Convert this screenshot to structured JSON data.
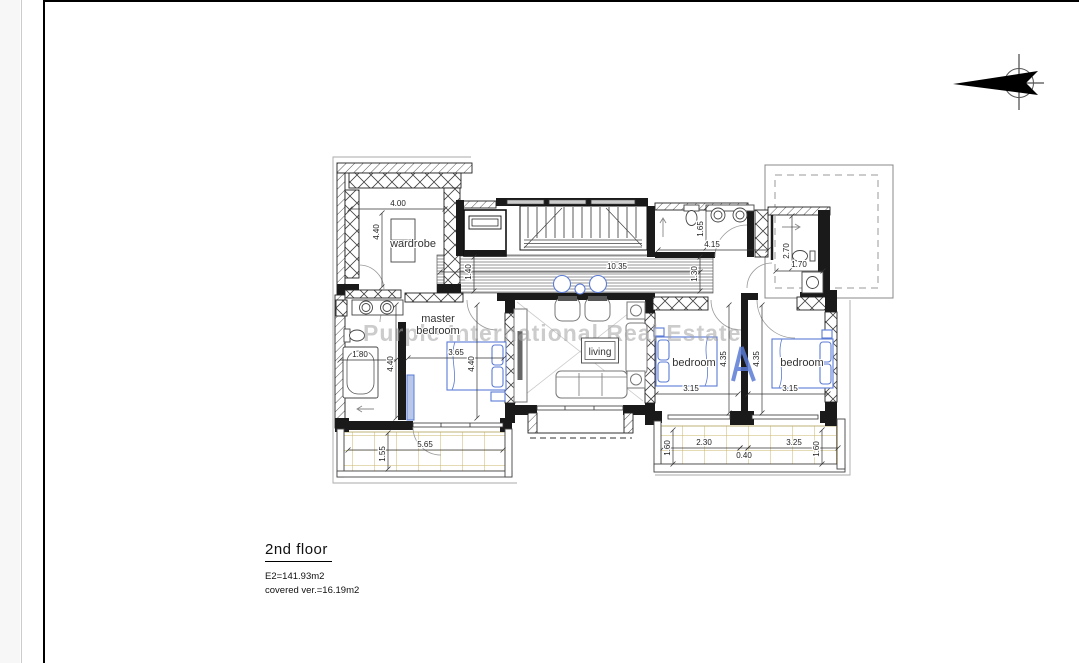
{
  "watermark": {
    "text": "Purple International Real Estate",
    "logo": "blue-a-logo"
  },
  "north_arrow": {
    "icon": "north-arrow-icon",
    "direction": "east"
  },
  "title_block": {
    "floor_label": "2nd floor",
    "area_line": "E2=141.93m2",
    "covered_line": "covered ver.=16.19m2"
  },
  "colors": {
    "wall": "#1a1a1a",
    "furniture_blue": "#5b7bd5",
    "tile": "#c8b668",
    "watermark": "#a3a3a3"
  },
  "plan": {
    "room_labels": [
      {
        "t": "wardrobe",
        "x": 413,
        "y": 247,
        "fs": 11
      },
      {
        "t": "master",
        "x": 438,
        "y": 322,
        "fs": 11
      },
      {
        "t": "bedroom",
        "x": 438,
        "y": 334,
        "fs": 11
      },
      {
        "t": "living",
        "x": 600,
        "y": 355,
        "fs": 10
      },
      {
        "t": "bedroom",
        "x": 694,
        "y": 366,
        "fs": 11
      },
      {
        "t": "bedroom",
        "x": 802,
        "y": 366,
        "fs": 11
      }
    ],
    "dimensions": [
      {
        "t": "4.00",
        "x": 398,
        "y": 206,
        "r": 0
      },
      {
        "t": "4.40",
        "x": 379,
        "y": 232,
        "r": -90
      },
      {
        "t": "10.35",
        "x": 617,
        "y": 269,
        "r": 0
      },
      {
        "t": "1.40",
        "x": 471,
        "y": 272,
        "r": -90
      },
      {
        "t": "4.15",
        "x": 712,
        "y": 247,
        "r": 0
      },
      {
        "t": "1.65",
        "x": 703,
        "y": 229,
        "r": -90
      },
      {
        "t": "1.30",
        "x": 697,
        "y": 274,
        "r": -90
      },
      {
        "t": "2.70",
        "x": 789,
        "y": 251,
        "r": -90
      },
      {
        "t": "1.70",
        "x": 799,
        "y": 267,
        "r": 0
      },
      {
        "t": "1.80",
        "x": 360,
        "y": 357,
        "r": 0
      },
      {
        "t": "4.40",
        "x": 393,
        "y": 364,
        "r": -90
      },
      {
        "t": "3.65",
        "x": 456,
        "y": 355,
        "r": 0
      },
      {
        "t": "4.40",
        "x": 474,
        "y": 364,
        "r": -90
      },
      {
        "t": "3.15",
        "x": 691,
        "y": 391,
        "r": 0
      },
      {
        "t": "4.35",
        "x": 726,
        "y": 359,
        "r": -90
      },
      {
        "t": "4.35",
        "x": 759,
        "y": 359,
        "r": -90
      },
      {
        "t": "3.15",
        "x": 790,
        "y": 391,
        "r": 0
      },
      {
        "t": "5.65",
        "x": 425,
        "y": 447,
        "r": 0
      },
      {
        "t": "1.55",
        "x": 385,
        "y": 454,
        "r": -90
      },
      {
        "t": "2.30",
        "x": 704,
        "y": 445,
        "r": 0
      },
      {
        "t": "0.40",
        "x": 744,
        "y": 458,
        "r": 0
      },
      {
        "t": "3.25",
        "x": 794,
        "y": 445,
        "r": 0
      },
      {
        "t": "1.60",
        "x": 670,
        "y": 448,
        "r": -90
      },
      {
        "t": "1.60",
        "x": 819,
        "y": 449,
        "r": -90
      }
    ],
    "dim_lines": [
      [
        350,
        209,
        445,
        209
      ],
      [
        382,
        213,
        382,
        287
      ],
      [
        440,
        272,
        700,
        272
      ],
      [
        474,
        257,
        474,
        291
      ],
      [
        658,
        250,
        768,
        250
      ],
      [
        706,
        208,
        706,
        248
      ],
      [
        700,
        257,
        700,
        291
      ],
      [
        792,
        216,
        792,
        268
      ],
      [
        776,
        271,
        823,
        271
      ],
      [
        340,
        360,
        396,
        360
      ],
      [
        396,
        305,
        396,
        418
      ],
      [
        408,
        358,
        504,
        358
      ],
      [
        477,
        305,
        477,
        418
      ],
      [
        656,
        394,
        738,
        394
      ],
      [
        729,
        305,
        729,
        413
      ],
      [
        762,
        305,
        762,
        413
      ],
      [
        748,
        394,
        828,
        394
      ],
      [
        348,
        450,
        503,
        450
      ],
      [
        388,
        433,
        388,
        469
      ],
      [
        663,
        448,
        740,
        448
      ],
      [
        740,
        448,
        748,
        448
      ],
      [
        748,
        448,
        838,
        448
      ],
      [
        673,
        430,
        673,
        464
      ],
      [
        822,
        430,
        822,
        464
      ]
    ]
  }
}
